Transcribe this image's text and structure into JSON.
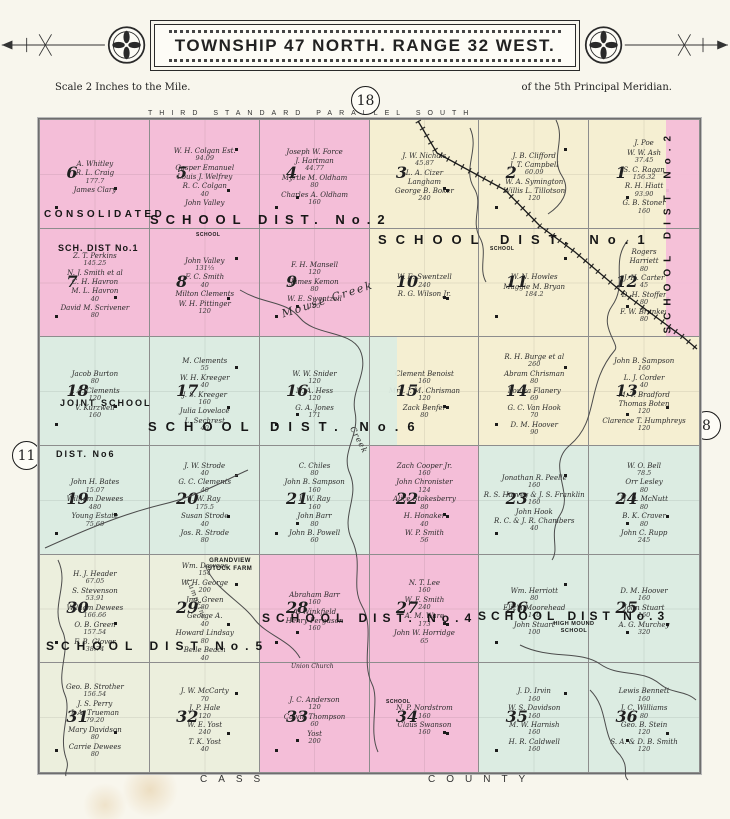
{
  "title": "TOWNSHIP 47 NORTH. RANGE 32 WEST.",
  "scale_note": "Scale 2 Inches to the Mile.",
  "meridian_note": "of the 5th Principal Meridian.",
  "page_numbers": {
    "top": "18",
    "right": "8",
    "left": "11"
  },
  "border_labels": {
    "top": "THIRD STANDARD PARALLEL SOUTH",
    "bottom_left": "CASS",
    "bottom_right": "COUNTY"
  },
  "colors": {
    "pink": "#f4bed8",
    "cream": "#f5efd2",
    "teal": "#dcece2",
    "ivory": "#ecefdd",
    "paper": "#f8f6ed"
  },
  "labels": [
    {
      "id": "parallel",
      "text": "THIRD STANDARD PARALLEL SOUTH"
    },
    {
      "id": "cass",
      "text": "CASS"
    },
    {
      "id": "county",
      "text": "COUNTY"
    },
    {
      "id": "consolidated",
      "text": "CONSOLIDATED"
    },
    {
      "id": "d2_big",
      "text": "SCHOOL DIST. No.2"
    },
    {
      "id": "d1_big",
      "text": "SCHOOL DIST. No.1"
    },
    {
      "id": "d1_small",
      "text": "SCH. DIST No.1"
    },
    {
      "id": "d2_vertical",
      "text": "SCHOOL DIST No.2"
    },
    {
      "id": "joint",
      "text": "JOINT SCHOOL"
    },
    {
      "id": "d6_big",
      "text": "SCHOOL DIST. No.6"
    },
    {
      "id": "d6_small",
      "text": "DIST. No6"
    },
    {
      "id": "d5_big",
      "text": "SCHOOL DIST No.5"
    },
    {
      "id": "d4_big",
      "text": "SCHOOL DIST. No.4"
    },
    {
      "id": "d3_big",
      "text": "SCHOOL DIST No.3"
    },
    {
      "id": "grandview",
      "text": "GRANDVIEW STOCK FARM"
    },
    {
      "id": "highmound",
      "text": "HIGH MOUND SCHOOL"
    },
    {
      "id": "union_church",
      "text": "Union Church"
    },
    {
      "id": "mouse_creek",
      "text": "Mouse Creek"
    },
    {
      "id": "creek_word",
      "text": "Creek"
    },
    {
      "id": "lumpkins",
      "text": "Lumpkins"
    },
    {
      "id": "school_tiny1",
      "text": "SCHOOL"
    },
    {
      "id": "school_tiny2",
      "text": "SCHOOL"
    },
    {
      "id": "school_tiny3",
      "text": "SCHOOL"
    }
  ],
  "sections": [
    {
      "num": "6",
      "color": "pink",
      "owners": [
        {
          "n": "A. Whitley"
        },
        {
          "n": "R. L. Craig",
          "a": "177.7"
        },
        {
          "n": "James Clary"
        }
      ]
    },
    {
      "num": "5",
      "color": "pink",
      "owners": [
        {
          "n": "W. H. Colgan Est.",
          "a": "94.09"
        },
        {
          "n": "Casper Emanuel"
        },
        {
          "n": "Louis J. Welfrey"
        },
        {
          "n": "R. C. Colgan",
          "a": "40"
        },
        {
          "n": "John Valley"
        }
      ]
    },
    {
      "num": "4",
      "color": "pink",
      "owners": [
        {
          "n": "Joseph W. Force"
        },
        {
          "n": "J. Hartman",
          "a": "44.77"
        },
        {
          "n": "Myrtle M. Oldham",
          "a": "80"
        },
        {
          "n": "Charles A. Oldham",
          "a": "160"
        }
      ]
    },
    {
      "num": "3",
      "color": "cream",
      "owners": [
        {
          "n": "J. W. Nichols",
          "a": "45.87"
        },
        {
          "n": "L. A. Cizer"
        },
        {
          "n": "Langham"
        },
        {
          "n": "George B. Boker",
          "a": "240"
        }
      ]
    },
    {
      "num": "2",
      "color": "cream",
      "owners": [
        {
          "n": "J. B. Clifford"
        },
        {
          "n": "J. T. Campbell",
          "a": "60.09"
        },
        {
          "n": "W. A. Symington"
        },
        {
          "n": "Willis L. Tillotson",
          "a": "120"
        }
      ]
    },
    {
      "num": "1",
      "color": "cream",
      "strip": {
        "side": "right",
        "color": "pink",
        "w": 0.3
      },
      "owners": [
        {
          "n": "J. Poe"
        },
        {
          "n": "W. W. Ash",
          "a": "37.45"
        },
        {
          "n": "S. C. Ragan",
          "a": "156.32"
        },
        {
          "n": "R. H. Hiatt",
          "a": "93.90"
        },
        {
          "n": "G. B. Stoner",
          "a": "160"
        }
      ]
    },
    {
      "num": "7",
      "color": "pink",
      "owners": [
        {
          "n": "Z. T. Perkins",
          "a": "145.25"
        },
        {
          "n": "N. J. Smith et al"
        },
        {
          "n": "C. H. Havron"
        },
        {
          "n": "M. L. Havron",
          "a": "40"
        },
        {
          "n": "David M. Scrivener",
          "a": "80"
        }
      ]
    },
    {
      "num": "8",
      "color": "pink",
      "owners": [
        {
          "n": "John Valley",
          "a": "131⅓"
        },
        {
          "n": "F. C. Smith",
          "a": "40"
        },
        {
          "n": "Milton Clements"
        },
        {
          "n": "W. H. Pittinger",
          "a": "120"
        }
      ]
    },
    {
      "num": "9",
      "color": "pink",
      "owners": [
        {
          "n": "F. H. Mansell",
          "a": "120"
        },
        {
          "n": "James Kemon",
          "a": "80"
        },
        {
          "n": "W. E. Swentzell",
          "a": "195"
        }
      ]
    },
    {
      "num": "10",
      "color": "cream",
      "owners": [
        {
          "n": "W. E. Swentzell",
          "a": "240"
        },
        {
          "n": "R. G. Wilson Jr."
        }
      ]
    },
    {
      "num": "11",
      "color": "cream",
      "owners": [
        {
          "n": "W. N. Howles"
        },
        {
          "n": "Maggie M. Bryan",
          "a": "184.2"
        }
      ]
    },
    {
      "num": "12",
      "color": "cream",
      "strip": {
        "side": "right",
        "color": "pink",
        "w": 0.3
      },
      "owners": [
        {
          "n": "Rogers"
        },
        {
          "n": "Harriett",
          "a": "80"
        },
        {
          "n": "J. H. Carter",
          "a": "45"
        },
        {
          "n": "D. H. Stoffer",
          "a": "80"
        },
        {
          "n": "F. W. Brunker",
          "a": "80"
        }
      ]
    },
    {
      "num": "18",
      "color": "teal",
      "owners": [
        {
          "n": "Jacob Burton",
          "a": "80"
        },
        {
          "n": "J. A. Clements",
          "a": "120"
        },
        {
          "n": "V. Kurzweil",
          "a": "160"
        }
      ]
    },
    {
      "num": "17",
      "color": "teal",
      "owners": [
        {
          "n": "M. Clements",
          "a": "55"
        },
        {
          "n": "W. H. Kreeger",
          "a": "40"
        },
        {
          "n": "J. S. Kreeger",
          "a": "160"
        },
        {
          "n": "Julia Lovelace"
        },
        {
          "n": "L. Sechrest",
          "a": "40"
        }
      ]
    },
    {
      "num": "16",
      "color": "teal",
      "owners": [
        {
          "n": "W. W. Snider",
          "a": "120"
        },
        {
          "n": "N. A. Hess",
          "a": "120"
        },
        {
          "n": "G. A. Jones",
          "a": "171"
        }
      ]
    },
    {
      "num": "15",
      "color": "cream",
      "strip": {
        "side": "left",
        "color": "teal",
        "w": 0.25
      },
      "owners": [
        {
          "n": "Clement Benoist",
          "a": "160"
        },
        {
          "n": "Mrs. J. M. Chrisman",
          "a": "120"
        },
        {
          "n": "Zack Benfer",
          "a": "80"
        }
      ]
    },
    {
      "num": "14",
      "color": "cream",
      "owners": [
        {
          "n": "R. H. Burge et al",
          "a": "260"
        },
        {
          "n": "Abram Chrisman",
          "a": "80"
        },
        {
          "n": "Louisa Flanery",
          "a": "69"
        },
        {
          "n": "G. C. Van Hook",
          "a": "70"
        },
        {
          "n": "D. M. Hoover",
          "a": "90"
        }
      ]
    },
    {
      "num": "13",
      "color": "cream",
      "owners": [
        {
          "n": "John B. Sampson",
          "a": "160"
        },
        {
          "n": "L. J. Corder",
          "a": "40"
        },
        {
          "n": "M. T. Bradford"
        },
        {
          "n": "Thomas Boten",
          "a": "120"
        },
        {
          "n": "Clarence T. Humphreys",
          "a": "120"
        }
      ]
    },
    {
      "num": "19",
      "color": "teal",
      "owners": [
        {
          "n": "John H. Bates",
          "a": "15.07"
        },
        {
          "n": "William Dewees",
          "a": "480"
        },
        {
          "n": "Young Estate",
          "a": "75.69"
        }
      ]
    },
    {
      "num": "20",
      "color": "teal",
      "owners": [
        {
          "n": "J. W. Strode",
          "a": "40"
        },
        {
          "n": "G. C. Clements",
          "a": "40"
        },
        {
          "n": "I. W. Ray",
          "a": "175.5"
        },
        {
          "n": "Susan Strode",
          "a": "40"
        },
        {
          "n": "Jos. R. Strode",
          "a": "80"
        }
      ]
    },
    {
      "num": "21",
      "color": "teal",
      "owners": [
        {
          "n": "C. Chiles",
          "a": "80"
        },
        {
          "n": "John B. Sampson",
          "a": "160"
        },
        {
          "n": "I. W. Ray",
          "a": "160"
        },
        {
          "n": "John Barr",
          "a": "80"
        },
        {
          "n": "John B. Powell",
          "a": "60"
        }
      ]
    },
    {
      "num": "22",
      "color": "pink",
      "owners": [
        {
          "n": "Zach Cooper Jr.",
          "a": "160"
        },
        {
          "n": "John Chronister",
          "a": "124"
        },
        {
          "n": "Alice Stokesberry",
          "a": "80"
        },
        {
          "n": "H. Honaker",
          "a": "40"
        },
        {
          "n": "W. P. Smith",
          "a": "56"
        }
      ]
    },
    {
      "num": "23",
      "color": "teal",
      "owners": [
        {
          "n": "Jonathan R. Peelle",
          "a": "160"
        },
        {
          "n": "R. S. Harvey & J. S. Franklin",
          "a": "160"
        },
        {
          "n": "John Hook"
        },
        {
          "n": "R. C. & J. R. Chambers",
          "a": "40"
        }
      ]
    },
    {
      "num": "24",
      "color": "teal",
      "owners": [
        {
          "n": "W. O. Bell",
          "a": "78.5"
        },
        {
          "n": "Orr Lesley",
          "a": "80"
        },
        {
          "n": "H. D. McNutt",
          "a": "80"
        },
        {
          "n": "B. K. Craver",
          "a": "80"
        },
        {
          "n": "John C. Rupp",
          "a": "245"
        }
      ]
    },
    {
      "num": "30",
      "color": "cream2",
      "owners": [
        {
          "n": "H. J. Header",
          "a": "67.05"
        },
        {
          "n": "S. Stevenson",
          "a": "53.91"
        },
        {
          "n": "William Dewees",
          "a": "166.66"
        },
        {
          "n": "O. B. Green",
          "a": "157.54"
        },
        {
          "n": "F. B. Glover",
          "a": "38.74"
        }
      ]
    },
    {
      "num": "29",
      "color": "cream2",
      "owners": [
        {
          "n": "Wm. Dewees",
          "a": "154"
        },
        {
          "n": "W. H. George",
          "a": "200"
        },
        {
          "n": "Jno. Green",
          "a": "80"
        },
        {
          "n": "George A.",
          "a": "40"
        },
        {
          "n": "Howard Lindsay",
          "a": "80"
        },
        {
          "n": "Belle Beach",
          "a": "40"
        }
      ]
    },
    {
      "num": "28",
      "color": "pink",
      "owners": [
        {
          "n": "Abraham Barr",
          "a": "160"
        },
        {
          "n": "A. Winkfield"
        },
        {
          "n": "Henry Ferguson",
          "a": "160"
        }
      ]
    },
    {
      "num": "27",
      "color": "pink",
      "owners": [
        {
          "n": "N. T. Lee",
          "a": "160"
        },
        {
          "n": "W. F. Smith",
          "a": "240"
        },
        {
          "n": "A. M. Ware",
          "a": "173"
        },
        {
          "n": "John W. Horridge",
          "a": "65"
        }
      ]
    },
    {
      "num": "26",
      "color": "teal",
      "owners": [
        {
          "n": "Wm. Herriott",
          "a": "80"
        },
        {
          "n": "Eliz'h Moorehead",
          "a": "140"
        },
        {
          "n": "John Stuart",
          "a": "100"
        }
      ]
    },
    {
      "num": "25",
      "color": "teal",
      "owners": [
        {
          "n": "D. M. Hoover",
          "a": "160"
        },
        {
          "n": "John Stuart",
          "a": "160"
        },
        {
          "n": "A. G. Murchey",
          "a": "320"
        }
      ]
    },
    {
      "num": "31",
      "color": "cream2",
      "owners": [
        {
          "n": "Geo. B. Strother",
          "a": "156.54"
        },
        {
          "n": "J. S. Perry"
        },
        {
          "n": "J. A. Trueman",
          "a": "79.20"
        },
        {
          "n": "Mary Davidson",
          "a": "80"
        },
        {
          "n": "Carrie Dewees",
          "a": "80"
        }
      ]
    },
    {
      "num": "32",
      "color": "cream2",
      "owners": [
        {
          "n": "J. W. McCarty",
          "a": "70"
        },
        {
          "n": "J. P. Hale",
          "a": "120"
        },
        {
          "n": "W. E. Yost",
          "a": "240"
        },
        {
          "n": "T. K. Yost",
          "a": "40"
        }
      ]
    },
    {
      "num": "33",
      "color": "pink",
      "owners": [
        {
          "n": "J. C. Anderson",
          "a": "120"
        },
        {
          "n": "Calvin Thompson",
          "a": "60"
        },
        {
          "n": "Yost",
          "a": "200"
        }
      ]
    },
    {
      "num": "34",
      "color": "pink",
      "owners": [
        {
          "n": "N. P. Nordstrom",
          "a": "160"
        },
        {
          "n": "Claus Swanson",
          "a": "160"
        }
      ]
    },
    {
      "num": "35",
      "color": "teal",
      "owners": [
        {
          "n": "J. D. Irvin",
          "a": "160"
        },
        {
          "n": "W. S. Davidson",
          "a": "160"
        },
        {
          "n": "M. W. Harnish",
          "a": "160"
        },
        {
          "n": "H. R. Caldwell",
          "a": "160"
        }
      ]
    },
    {
      "num": "36",
      "color": "teal",
      "owners": [
        {
          "n": "Lewis Bennett",
          "a": "160"
        },
        {
          "n": "J. C. Williams",
          "a": "80"
        },
        {
          "n": "Geo. B. Stein",
          "a": "120"
        },
        {
          "n": "S. A. & D. B. Smith",
          "a": "120"
        }
      ]
    }
  ]
}
